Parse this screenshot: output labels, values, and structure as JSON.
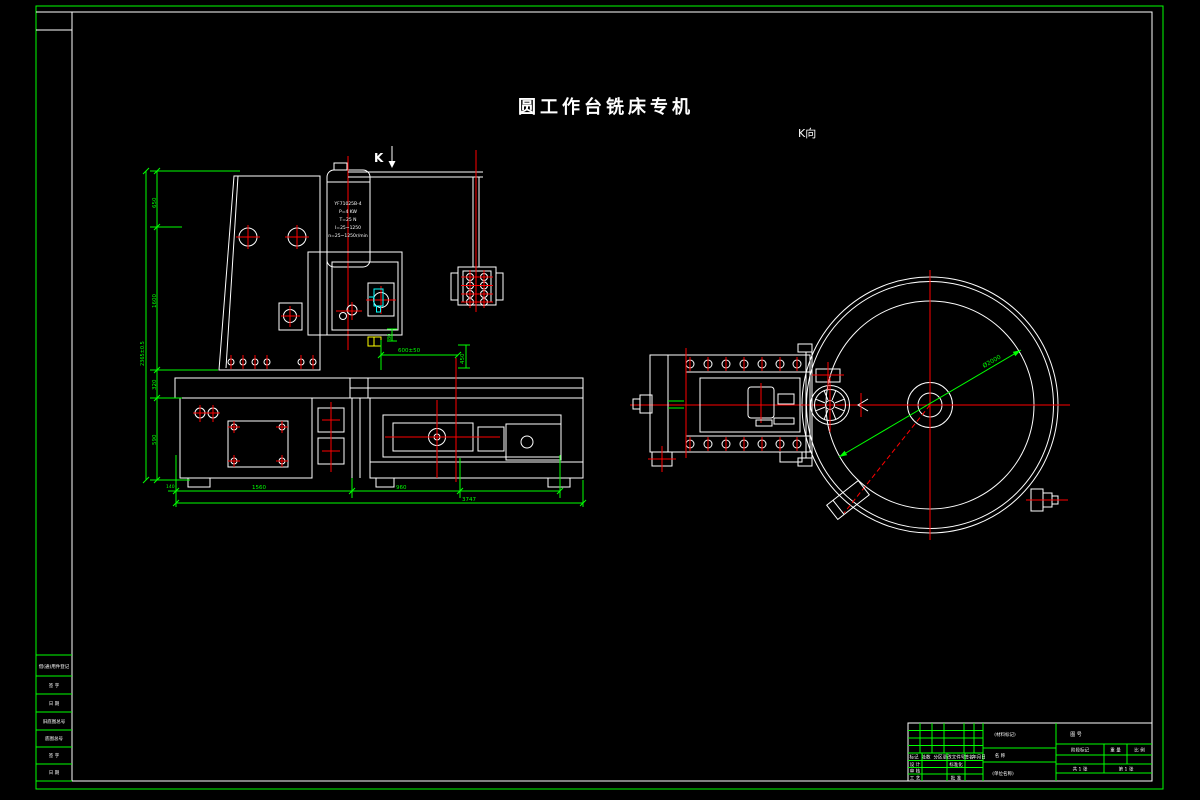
{
  "palette": {
    "bg": "#000000",
    "white": "#ffffff",
    "green": "#00ff00",
    "red": "#ff0000",
    "cyan": "#00ffff",
    "yellow": "#ffff00"
  },
  "drawing": {
    "title": "圆工作台铣床专机",
    "k_arrow_label": "K",
    "k_view_label": "K向",
    "motor_spec": [
      "YF71025B-4",
      "P=4 KW",
      "T=25 N",
      "I=25~1250",
      "n=25~1250r/min"
    ]
  },
  "dimensions": {
    "front": {
      "seg_small": "140",
      "seg1": "1560",
      "seg2": "960",
      "total": "3747",
      "v_top": "650",
      "v_mid": "1600",
      "v_overall": "2365±0.5",
      "v_low": "320",
      "v_lower": "590",
      "spindle_gap": "80",
      "table_len": "600±50",
      "saddle": "450"
    },
    "k_view": {
      "table_diameter": "Ø2000"
    }
  },
  "frame": {
    "side_labels": [
      "借(通)用件登记",
      "签 字",
      "日 期",
      "旧底图总号",
      "底图总号",
      "签 字",
      "日 期"
    ]
  },
  "title_block": {
    "material_mark": "(材料标记)",
    "name_label": "名 称",
    "unit_name": "(单位名称)",
    "drawing_code": "图 号",
    "stage_mark": "阶段标记",
    "weight_label": "重 量",
    "scale_label": "比 例",
    "sheet_total": "共 1 张",
    "sheet_number": "第 1 张",
    "revision_headers": [
      "标记",
      "处数",
      "分区",
      "更改文件号",
      "签名",
      "年月日"
    ],
    "role_design": "设 计",
    "role_standard": "标准化",
    "role_check": "审 核",
    "role_process": "工 艺",
    "role_approve": "批 准"
  }
}
